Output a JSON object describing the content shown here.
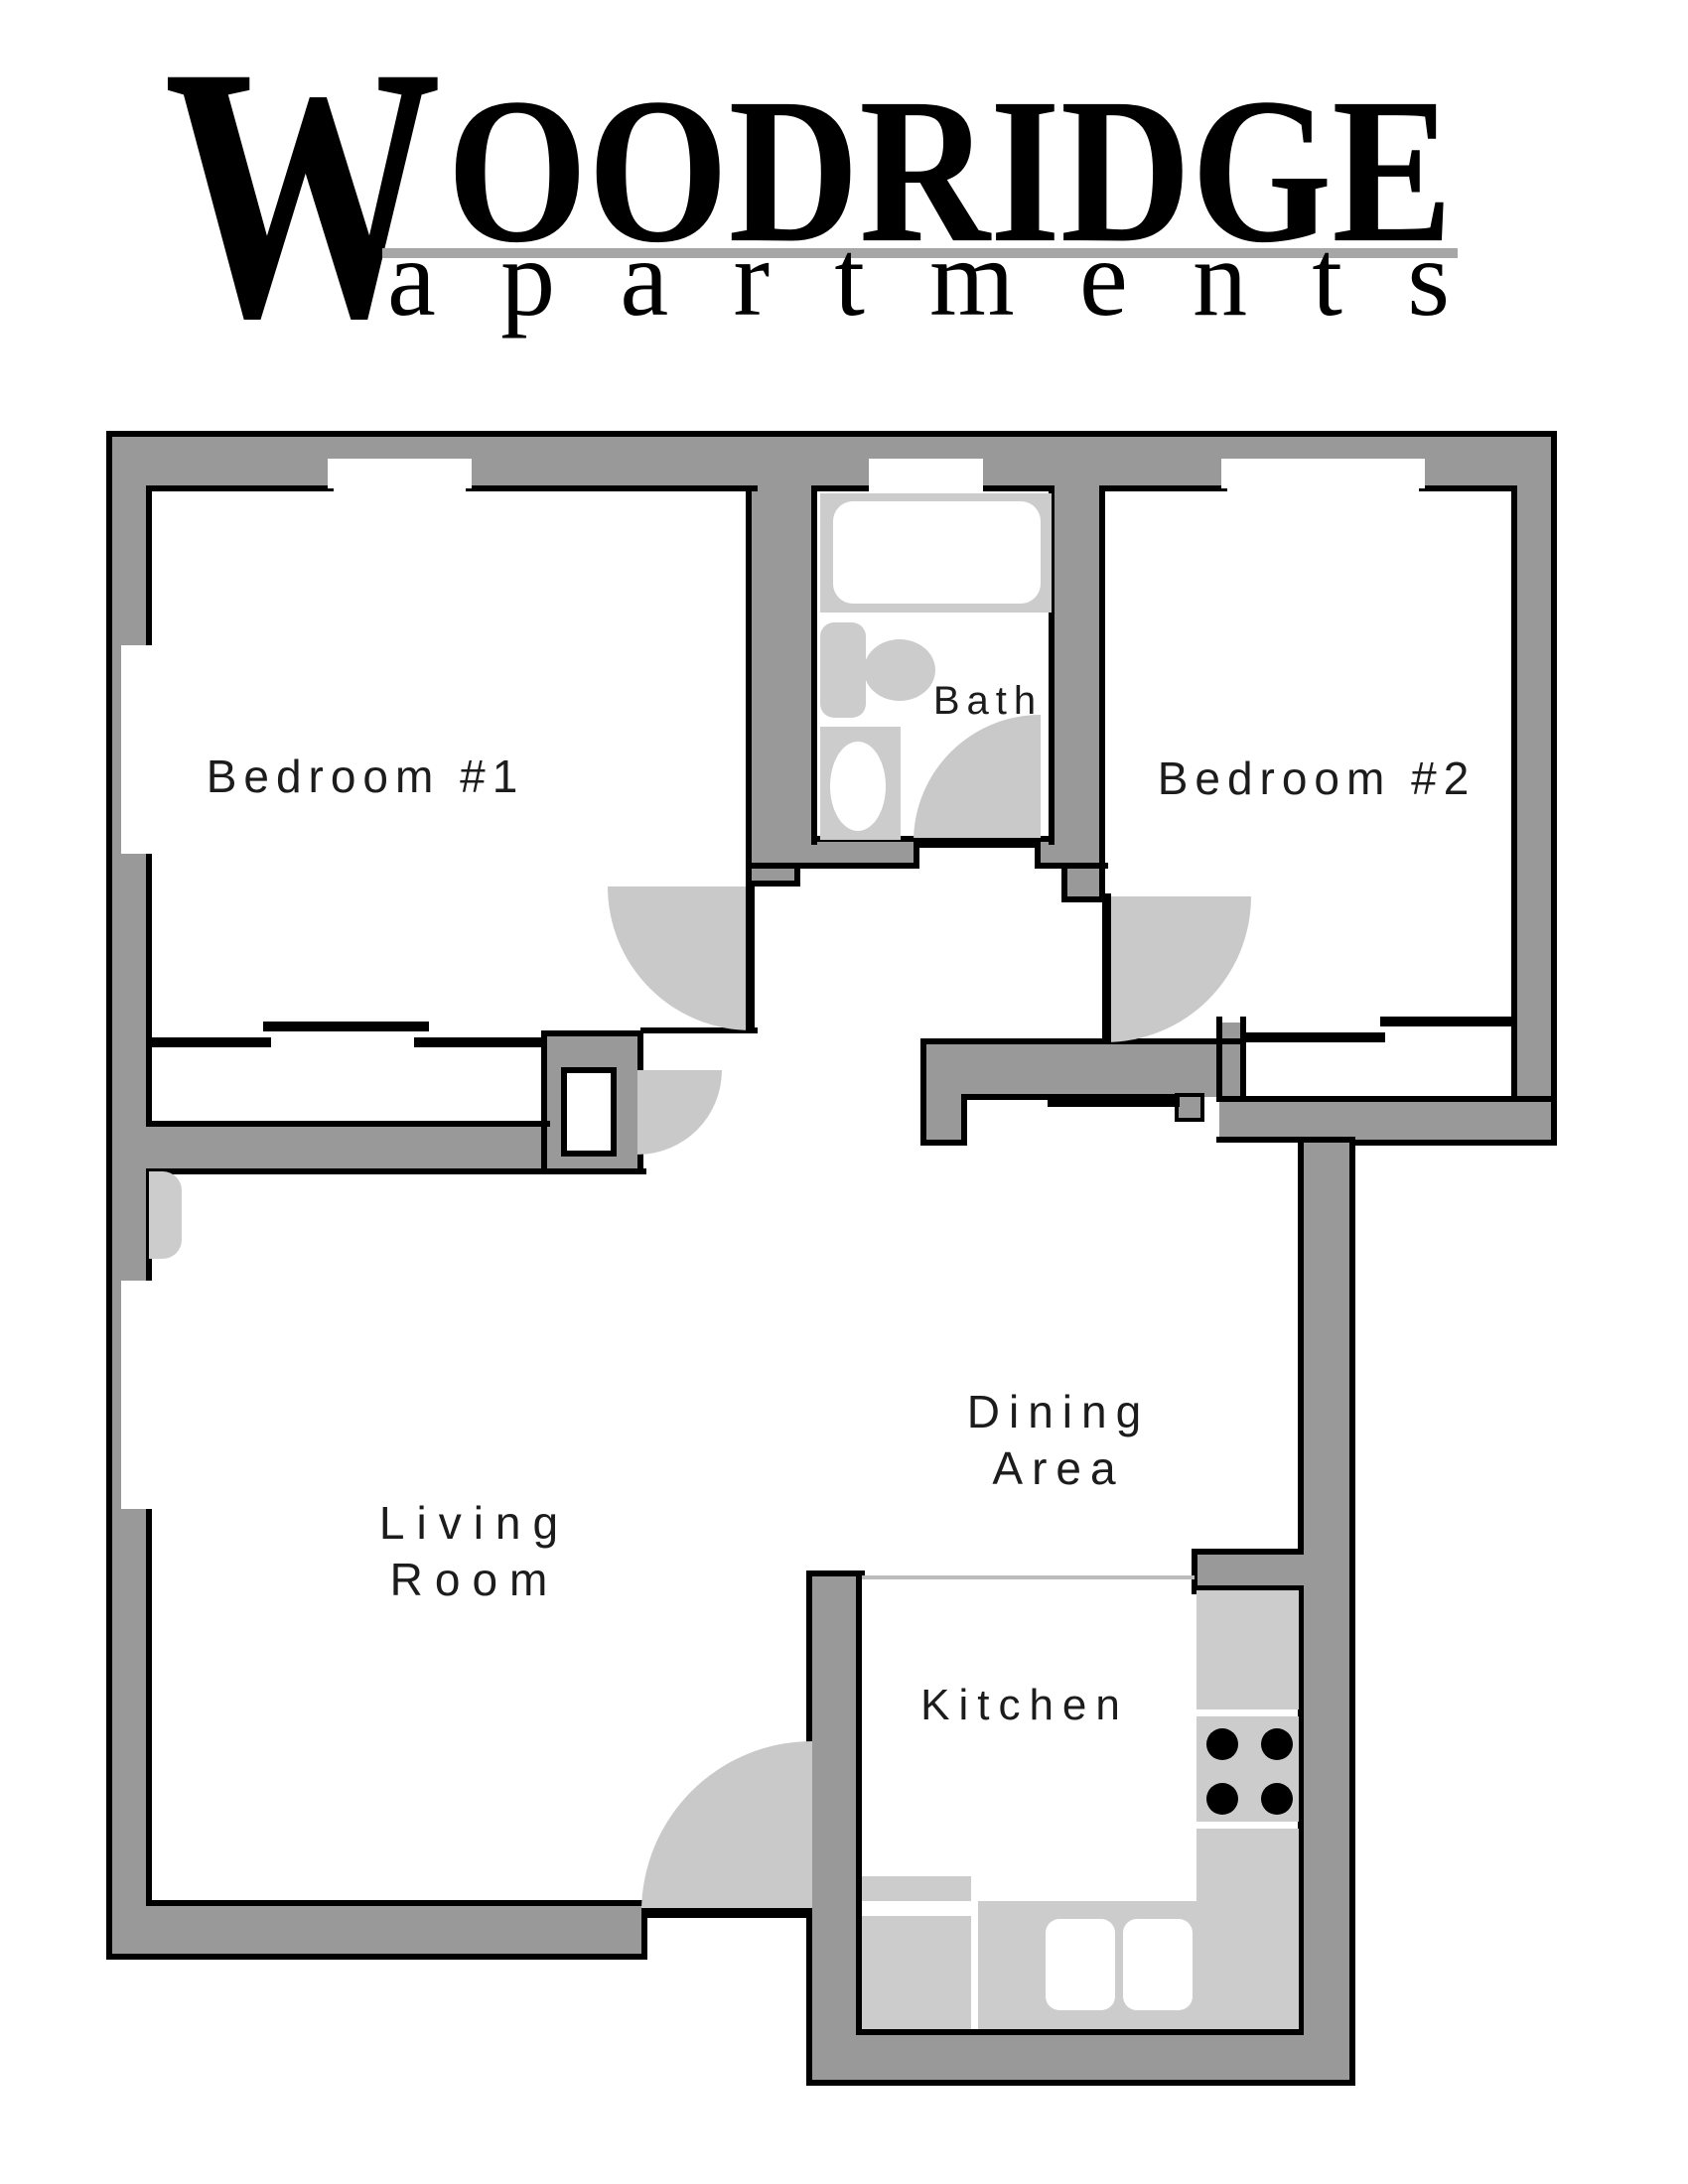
{
  "logo": {
    "word_initial": "W",
    "word_rest": "OODRIDGE",
    "title": "WOODRIDGE",
    "subtitle": "apartments"
  },
  "rooms": {
    "bedroom1": "Bedroom #1",
    "bedroom2": "Bedroom #2",
    "bath": "Bath",
    "dining_line1": "Dining",
    "dining_line2": "Area",
    "living_line1": "Living",
    "living_line2": "Room",
    "kitchen": "Kitchen"
  },
  "colors": {
    "wall": "#999999",
    "fixture": "#cccccc",
    "door_arc": "#c9c9c9",
    "outline": "#000000",
    "logo_underline": "#a6a6a6",
    "label": "#1c1c1c",
    "counter_line": "#bbbbbb"
  }
}
